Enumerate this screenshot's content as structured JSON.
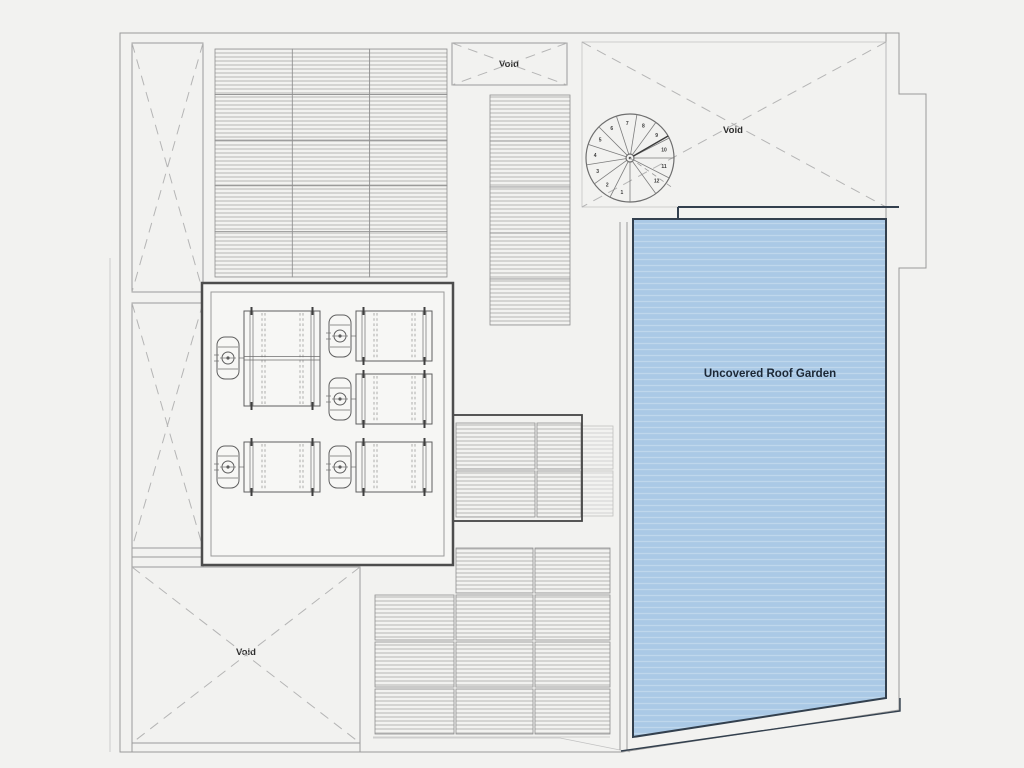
{
  "labels": {
    "void_top_center": "Void",
    "void_top_right": "Void",
    "void_bottom_left": "Void",
    "roof_garden": "Uncovered Roof Garden"
  },
  "stair": {
    "steps": [
      "1",
      "2",
      "3",
      "4",
      "5",
      "6",
      "7",
      "8",
      "9",
      "10",
      "11",
      "12"
    ]
  },
  "colors": {
    "page_background": "#f2f2f0",
    "plan_fill": "#f6f6f4",
    "garden_fill": "#aac9e6",
    "garden_stripe": "#bfd7ec",
    "garden_border": "#33404e",
    "garden_text": "#1c2836",
    "drawing_line": "#8f8f8f"
  }
}
